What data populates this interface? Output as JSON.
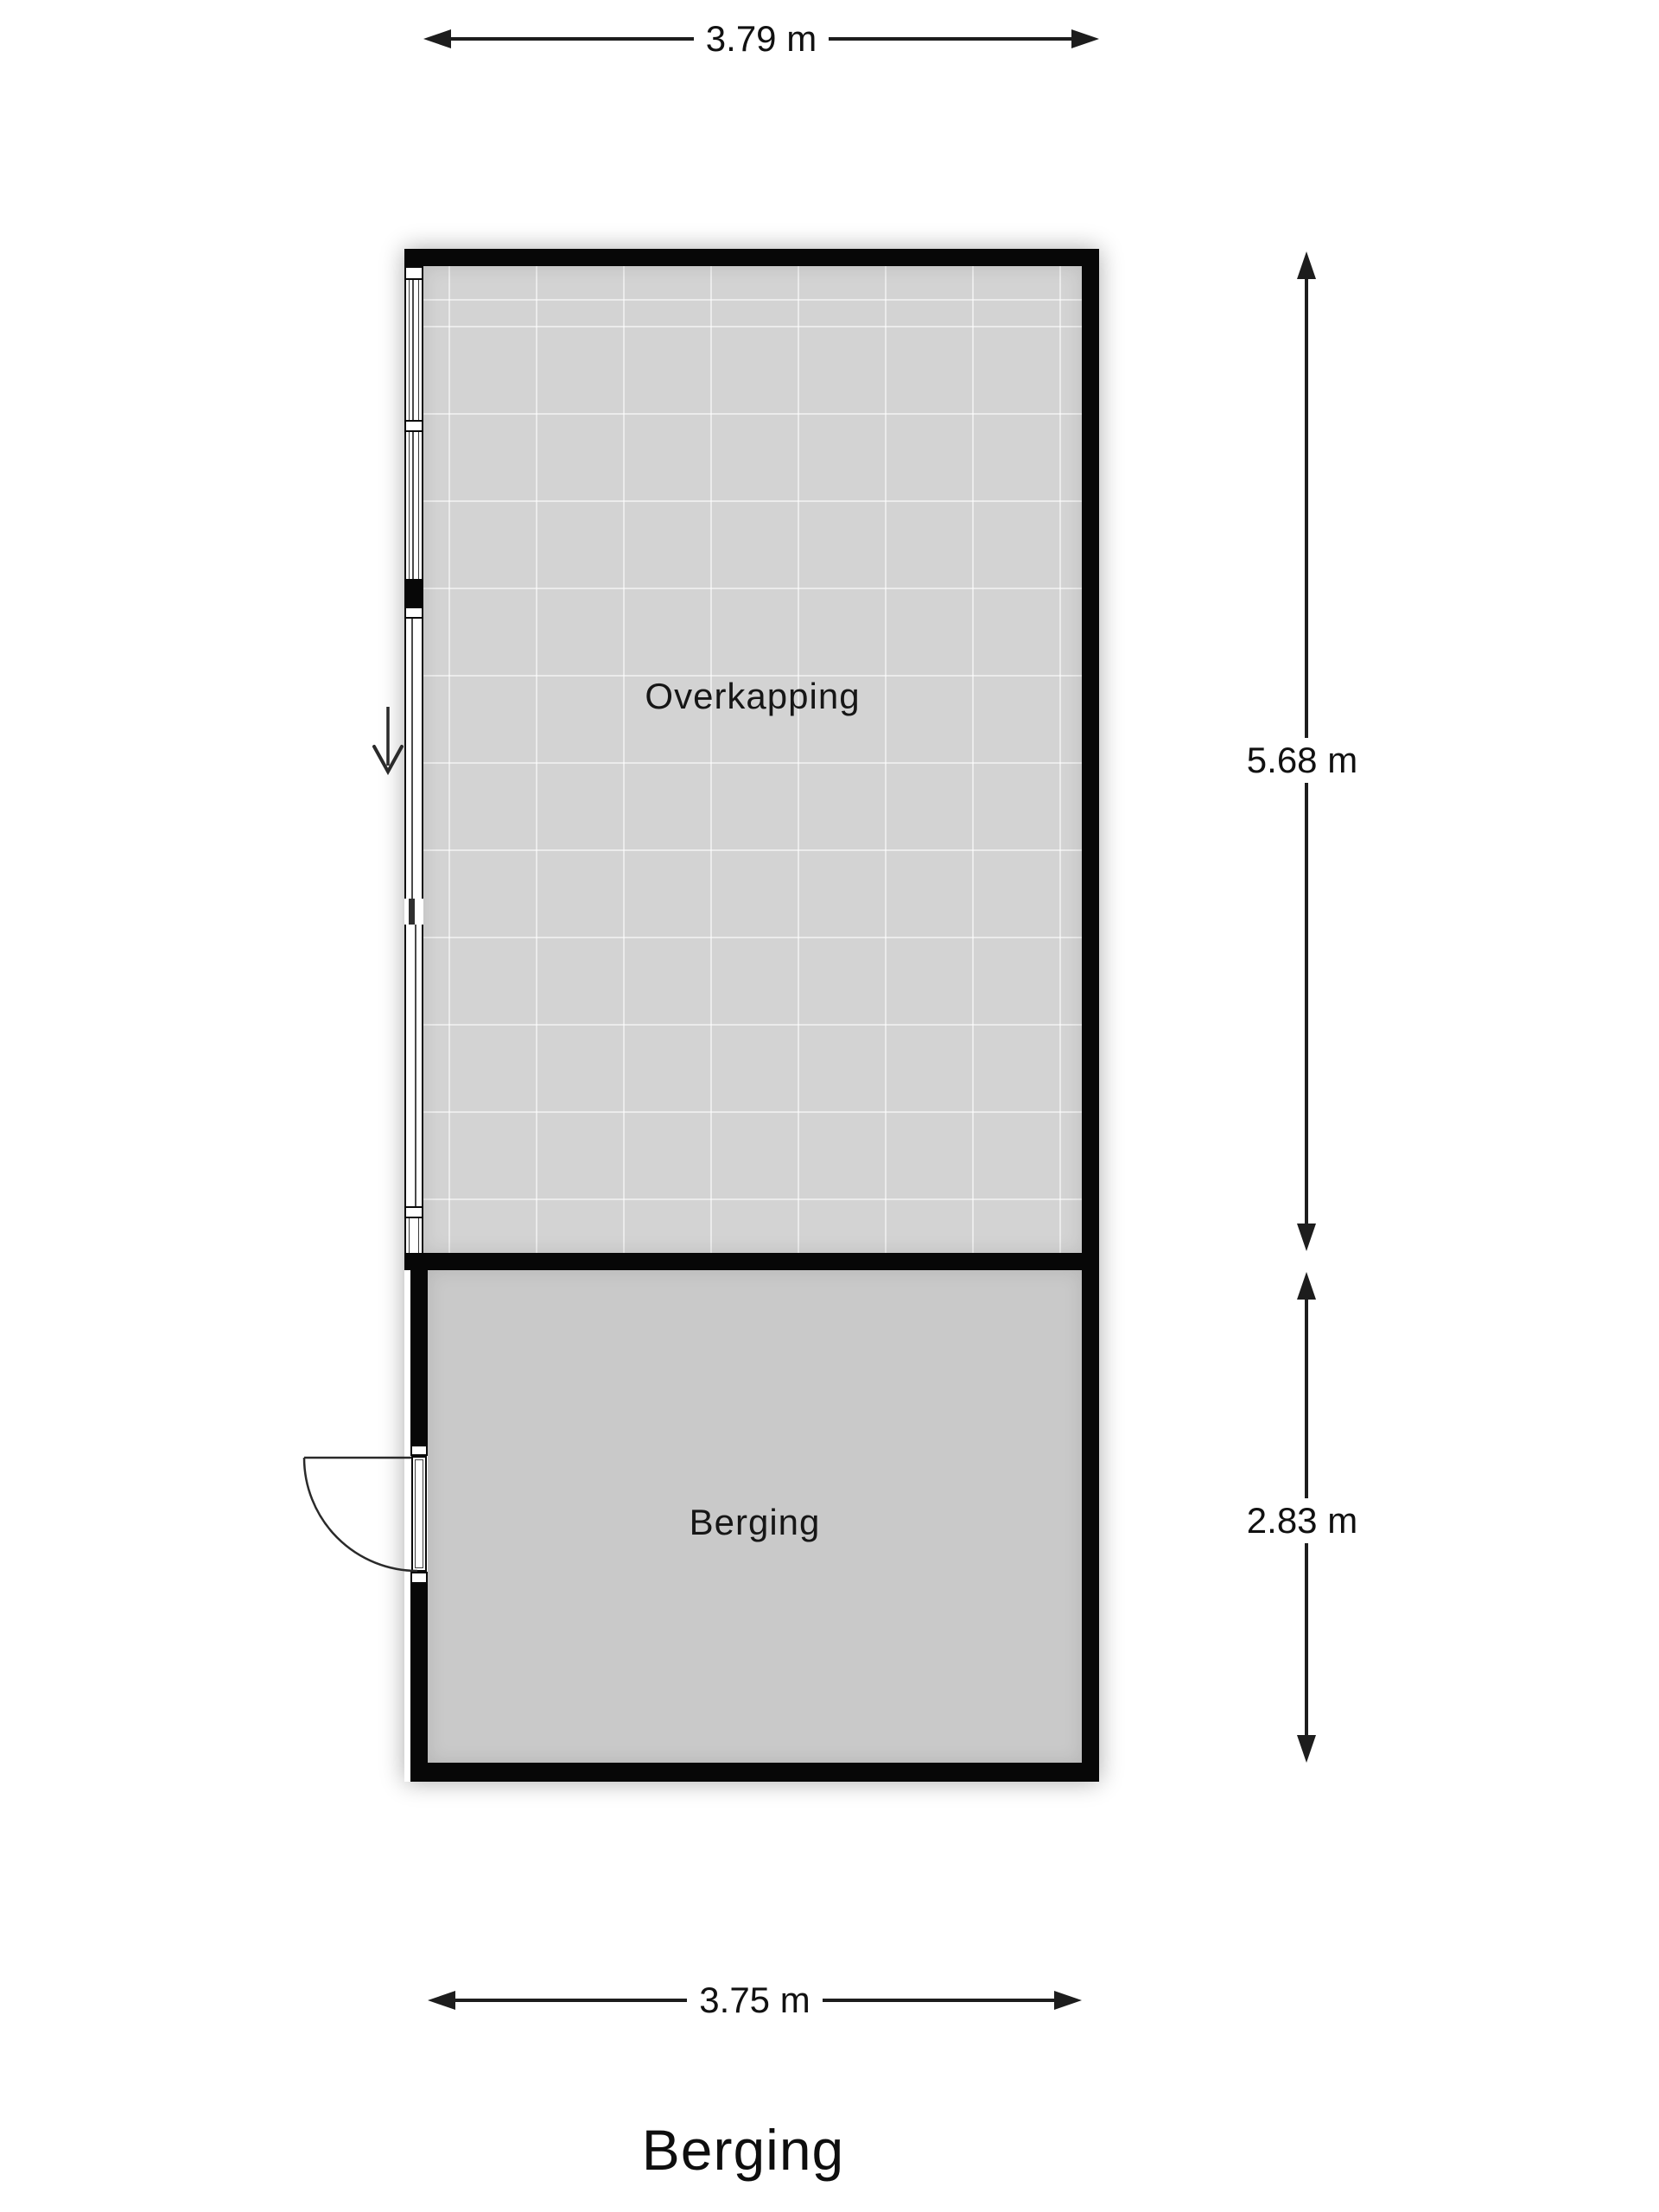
{
  "title": "Berging",
  "rooms": [
    {
      "name": "Overkapping"
    },
    {
      "name": "Berging"
    }
  ],
  "dimensions": {
    "top": "3.79 m",
    "right_upper": "5.68 m",
    "right_lower": "2.83 m",
    "bottom": "3.75 m"
  },
  "icons": {
    "entrance_arrow": "down-arrow",
    "door_swing": "quarter-arc"
  },
  "colors": {
    "wall": "#070707",
    "floor_overkapping": "#d3d3d3",
    "floor_tile_line": "#dddddd",
    "floor_berging": "#c9c9c9",
    "dimension_line": "#1d1d1d",
    "background": "#ffffff"
  }
}
